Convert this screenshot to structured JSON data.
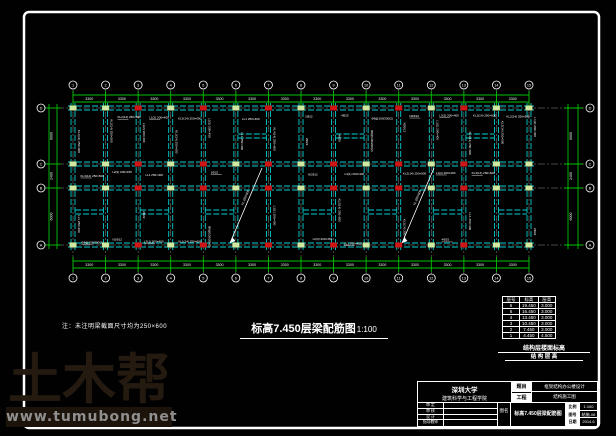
{
  "watermark": {
    "logo_text": "土木帮",
    "url_text": "www.tumubong.net"
  },
  "drawing": {
    "note": "注：未注明梁截面尺寸均为250×600",
    "title": "标高7.450层梁配筋图",
    "scale": "1:100",
    "grid": {
      "col_labels": [
        "1",
        "2",
        "3",
        "4",
        "5",
        "6",
        "7",
        "8",
        "9",
        "10",
        "11",
        "12",
        "13",
        "14",
        "15"
      ],
      "row_labels": [
        "D",
        "C",
        "B",
        "A"
      ],
      "bay_dim": "3300",
      "row_dims": [
        "6000",
        "2400",
        "6000"
      ]
    },
    "beam_label_pool": [
      "KL1(14) 250×600",
      "KL2(14) 250×500",
      "L1(2) 200×400",
      "KL3(14) 250×600",
      "L2(3) 200×450",
      "LL1 250×400",
      "KL4(14) 250×600",
      "2Φ22",
      "4Φ25",
      "Φ8@100/200(2)",
      "N2Φ12",
      "L3(1) 200×400"
    ],
    "diagonal_label": "XL 250×500"
  },
  "floor_table": {
    "headers": [
      "层号",
      "标高",
      "层高"
    ],
    "rows": [
      [
        "6",
        "19.450",
        "3.000"
      ],
      [
        "5",
        "16.450",
        "3.000"
      ],
      [
        "4",
        "13.450",
        "3.000"
      ],
      [
        "3",
        "10.450",
        "3.000"
      ],
      [
        "2",
        "7.450",
        "3.000"
      ],
      [
        "1",
        "4.450",
        "4.500"
      ]
    ],
    "caption_line1": "结构层楼面标高",
    "caption_line2": "结 构 层 高"
  },
  "title_block": {
    "school_line1": "深圳大学",
    "school_line2": "建筑科学与工程学院",
    "field_labels": [
      "题目",
      "工程"
    ],
    "project_line1": "框架结构办公楼设计",
    "project_line2": "结构施工图",
    "sign_rows": [
      "审 定",
      "审 核",
      "设 计",
      "指导教师"
    ],
    "name_label": "图名",
    "drawing_name": "标高7.450层梁配筋图",
    "meta": [
      {
        "label": "比例",
        "value": "1:100"
      },
      {
        "label": "图号",
        "value": "结施-06"
      },
      {
        "label": "日期",
        "value": "2014.6"
      }
    ]
  },
  "colors": {
    "beam": "#00cfcf",
    "dimension": "#00c400",
    "centerline": "#8a8a8a",
    "column_red": "#cf1515",
    "joint_green": "#cfe9a0",
    "text_white": "#ffffff",
    "watermark_brown": "#241a10",
    "url_gray": "#8f8f8f"
  }
}
